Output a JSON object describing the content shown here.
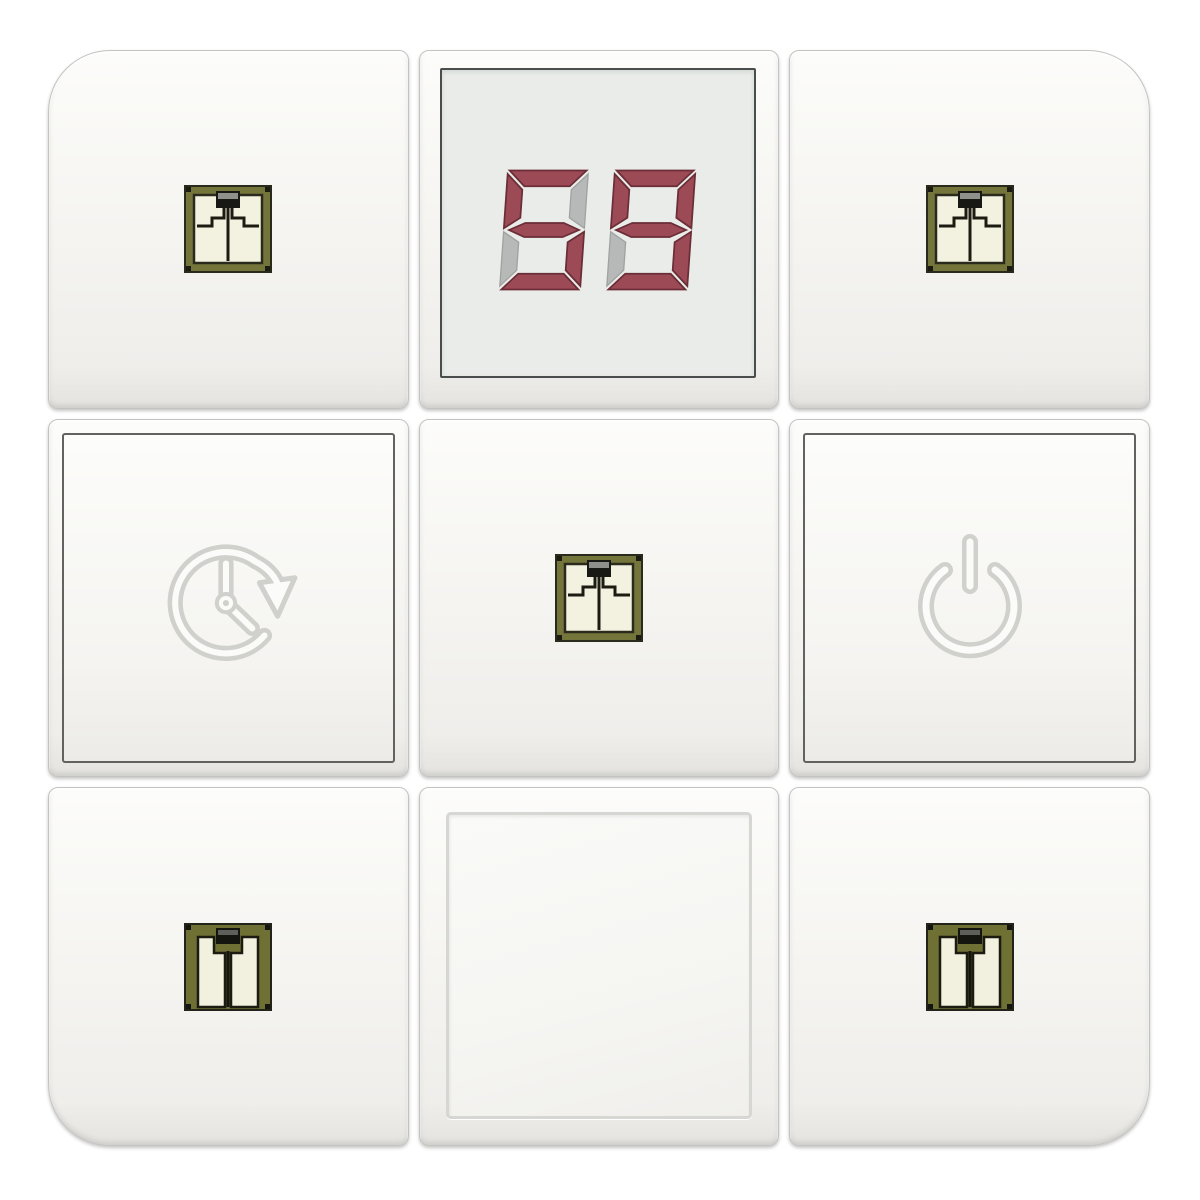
{
  "device": {
    "description": "white 3x3 touch key panel with countdown display",
    "background_color": "#ffffff",
    "tile_color": "#f6f5f2",
    "seam_color": "#c3c3c0"
  },
  "display": {
    "value": "59",
    "type": "seven-segment",
    "digit_count": 2,
    "active_color": "#9c4b56",
    "inactive_color": "#b6b9b7",
    "background_color": "#e9ece8",
    "border_color": "#494d4b"
  },
  "tiles": [
    {
      "position": "top-left",
      "icon": "smd-chip-icon"
    },
    {
      "position": "top-center",
      "icon": "seven-segment-display"
    },
    {
      "position": "top-right",
      "icon": "smd-chip-icon"
    },
    {
      "position": "middle-left",
      "icon": "timer-history-icon"
    },
    {
      "position": "middle-center",
      "icon": "smd-chip-icon"
    },
    {
      "position": "middle-right",
      "icon": "power-icon"
    },
    {
      "position": "bottom-left",
      "icon": "smd-chip-pads-icon"
    },
    {
      "position": "bottom-center",
      "icon": "blank-key"
    },
    {
      "position": "bottom-right",
      "icon": "smd-chip-pads-icon"
    }
  ],
  "colors": {
    "chip_frame_olive": "#74753a",
    "chip_body_olive": "#6e7034",
    "chip_pad_cream": "#f2f0de",
    "chip_trace_black": "#1b1b12",
    "emboss_gray": "#d0d0cc",
    "emboss_white": "#fbfbf9",
    "inset_frame_dark": "#626260",
    "inset_frame_light": "#d6d6d2"
  }
}
